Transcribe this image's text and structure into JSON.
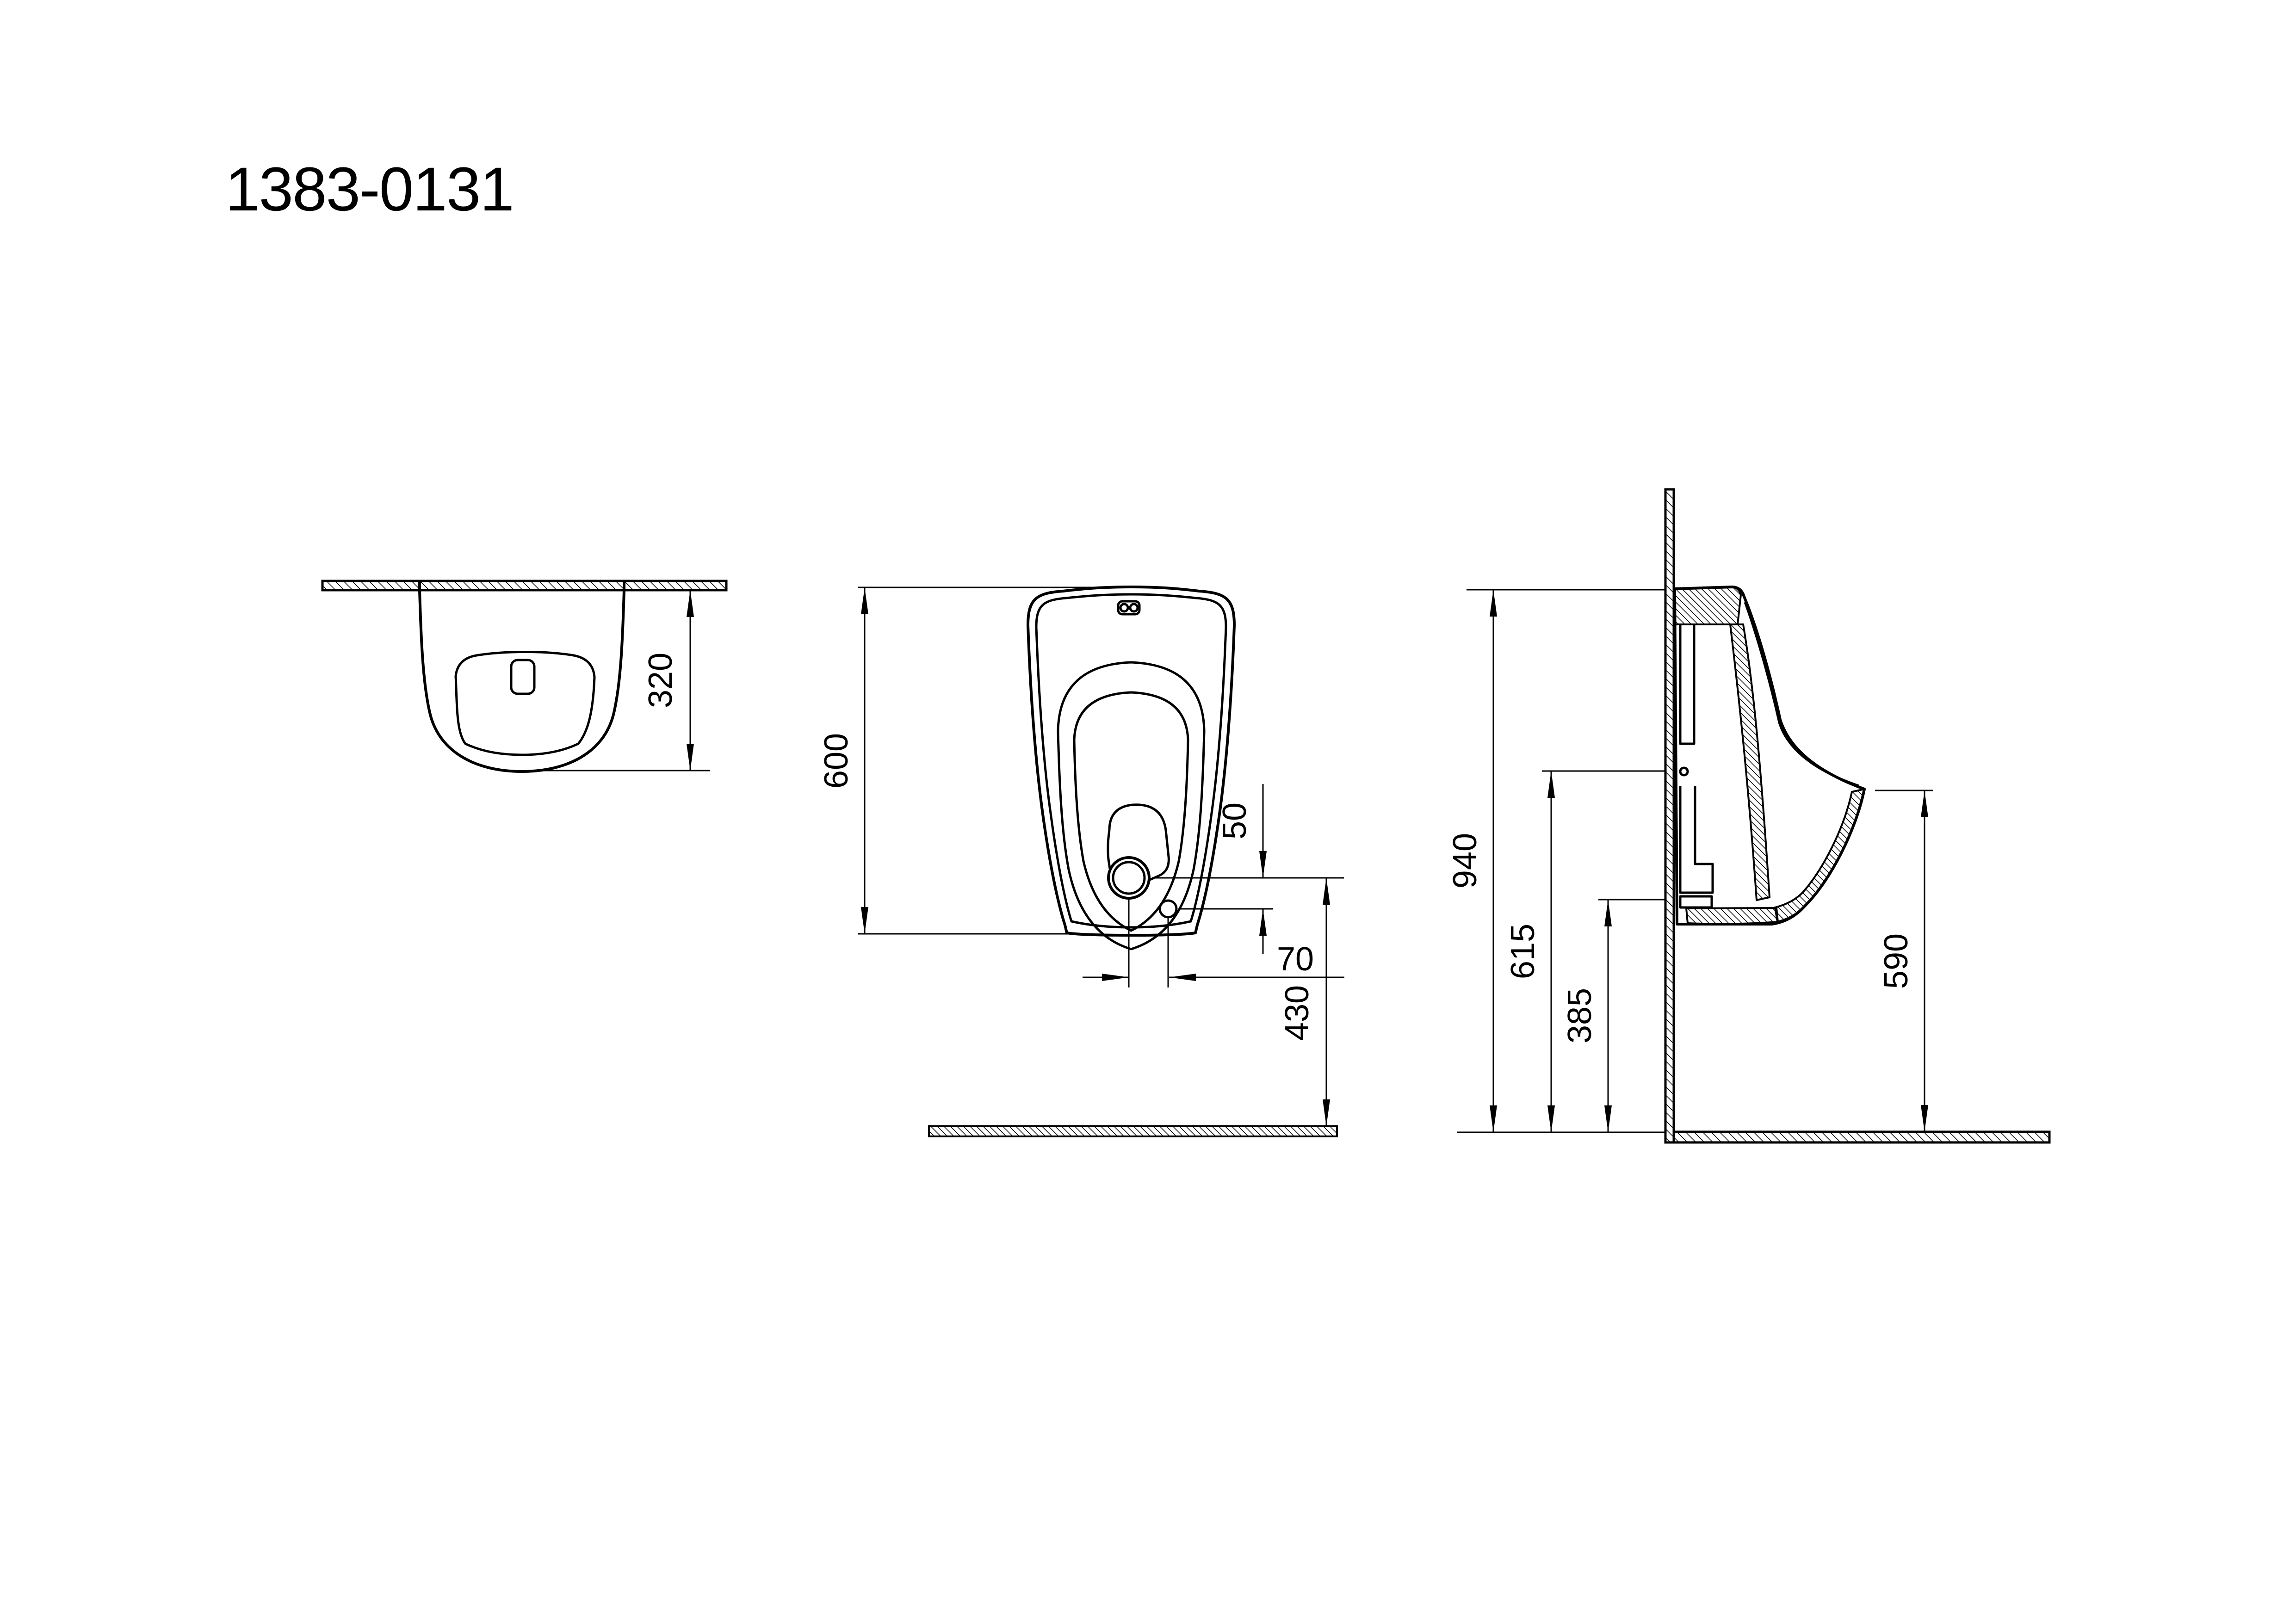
{
  "title": "1383-0131",
  "colors": {
    "ink": "#000000",
    "paper": "#ffffff"
  },
  "views": {
    "top": {
      "dims": {
        "depth": "320"
      }
    },
    "front": {
      "dims": {
        "height": "600",
        "spud_drop": "50",
        "hole_offset": "70",
        "outlet_to_floor": "430"
      }
    },
    "side": {
      "dims": {
        "wall_top": "940",
        "fixing_hole": "615",
        "outlet_height": "385",
        "rim_height": "590"
      }
    }
  }
}
